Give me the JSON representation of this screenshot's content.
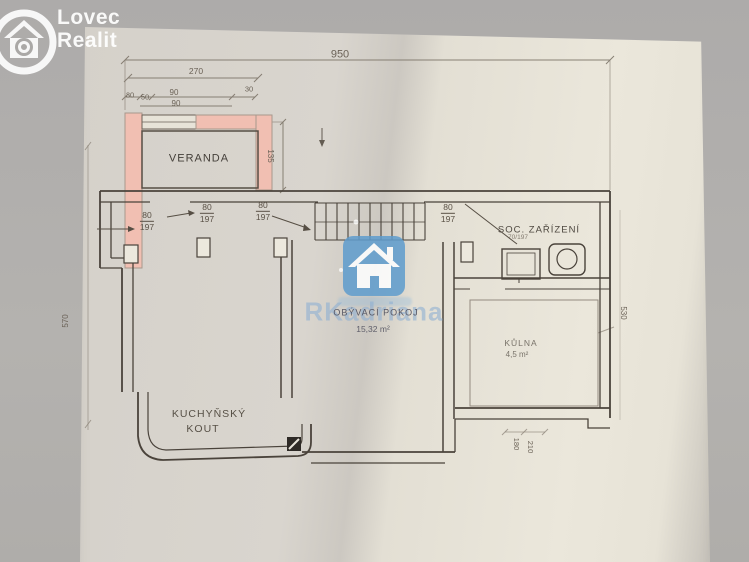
{
  "logo": {
    "line1": "Lovec",
    "line2": "Realit"
  },
  "watermark": {
    "brand": "RKadriana"
  },
  "rooms": {
    "veranda": "VERANDA",
    "soc_zarizeni": "SOC. ZAŘÍZENÍ",
    "obyvaci_pokoj": "OBÝVACÍ POKOJ",
    "obyvaci_area": "15,32 m²",
    "kulna": "KŮLNA",
    "kulna_area": "4,5 m²",
    "kuchynsky": "KUCHYŇSKÝ",
    "kout": "KOUT"
  },
  "dimensions": {
    "total_width": "950",
    "veranda_total": "270",
    "seg_a": "30",
    "seg_b": "50",
    "seg_c": "90",
    "seg_d": "30",
    "seg_e": "90",
    "veranda_depth": "135",
    "left_side": "570",
    "right_side": "530",
    "bottom_a": "180",
    "bottom_b": "210",
    "small_door": "70/197"
  },
  "doors": {
    "door1": {
      "w": "80",
      "h": "197"
    },
    "door2": {
      "w": "80",
      "h": "197"
    },
    "door3": {
      "w": "80",
      "h": "197"
    },
    "door4": {
      "w": "80",
      "h": "197"
    }
  },
  "colors": {
    "paper": "#e6e2d7",
    "background": "#b3b1ae",
    "wall_highlight": "#f1bfb2",
    "ink": "#4c443c",
    "watermark_blue": "#5f9ccd"
  }
}
